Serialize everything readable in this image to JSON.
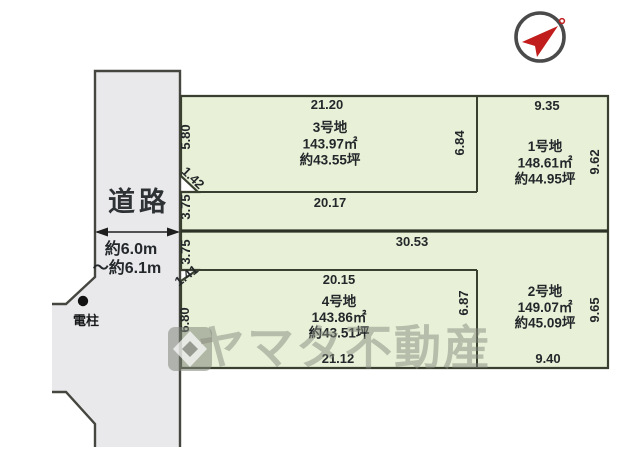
{
  "diagram_type": "land-lot-subdivision-plan",
  "colors": {
    "plot_fill": "#e8f1d8",
    "road_fill": "#e9e9ec",
    "boundary_line": "#3a402f",
    "compass_red": "#c21d1d",
    "watermark_gray": "#878b7f"
  },
  "road": {
    "label": "道路",
    "width_note_line1": "約6.0m",
    "width_note_line2": "～約6.1m",
    "utility_pole_label": "電柱"
  },
  "boundary": {
    "total_width": "30.53",
    "pole1_frontage": "3.75",
    "pole2_frontage": "3.75"
  },
  "plots": {
    "plot1": {
      "label": "1号地",
      "area": "148.61㎡",
      "tsubo": "約44.95坪",
      "top": "9.35",
      "right": "9.62"
    },
    "plot2": {
      "label": "2号地",
      "area": "149.07㎡",
      "tsubo": "約45.09坪",
      "right": "9.65",
      "bottom": "9.40"
    },
    "plot3": {
      "label": "3号地",
      "area": "143.97㎡",
      "tsubo": "約43.55坪",
      "top": "21.20",
      "left": "5.80",
      "right": "6.84",
      "bottom": "20.17",
      "corner_cut": "1.42"
    },
    "plot4": {
      "label": "4号地",
      "area": "143.86㎡",
      "tsubo": "約43.51坪",
      "top": "20.15",
      "left": "6.80",
      "right": "6.87",
      "bottom": "21.12",
      "corner_cut": "1.41"
    }
  },
  "watermark": {
    "text": "ヤマタ不動産"
  }
}
